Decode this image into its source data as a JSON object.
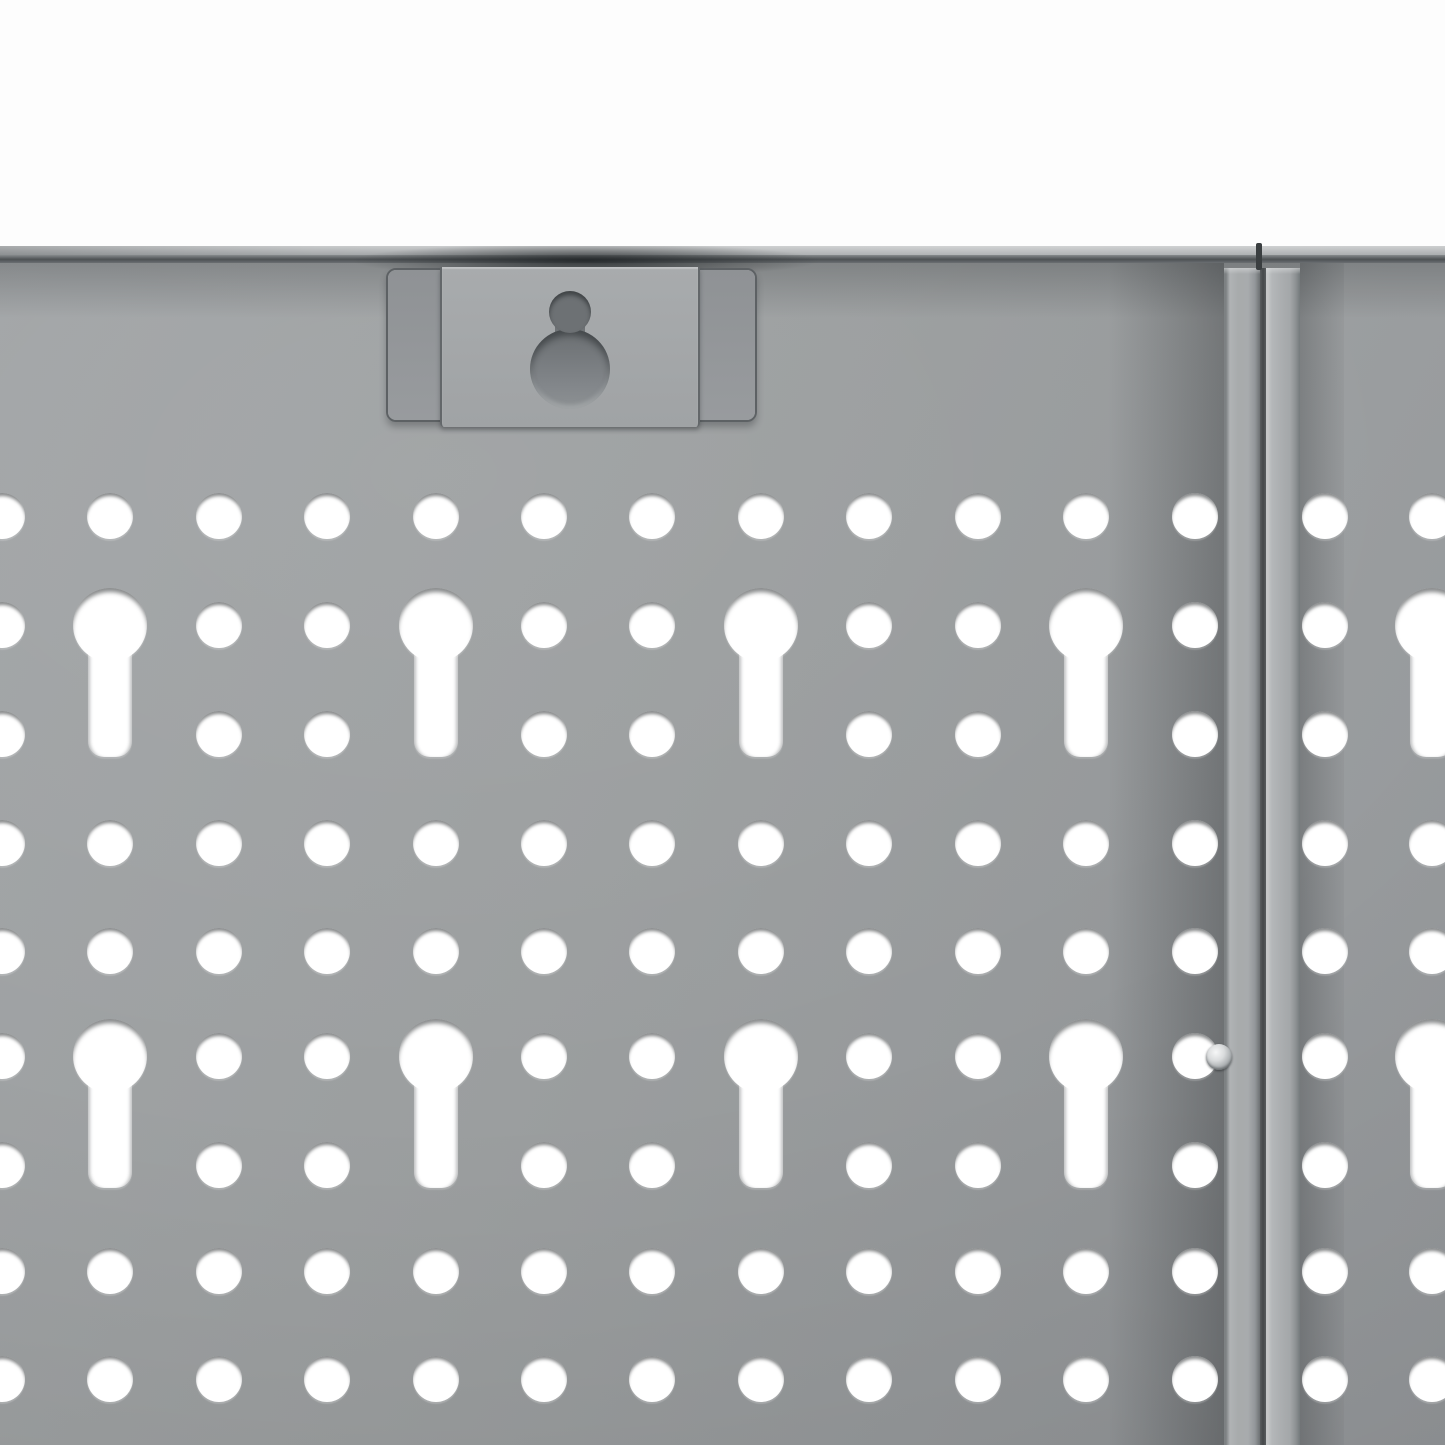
{
  "colors": {
    "background": "#fdfdfd",
    "panel-base": "#9b9e9f",
    "panel-light": "#a2a5a7",
    "panel-dark": "#8f9295",
    "hole-white": "#ffffff",
    "edge-line-dark": "#4d5154",
    "top-band-light": "#c9cbcc",
    "strip-face": "#a8abad",
    "strip-face-right": "#abaeb0",
    "bracket-face": "#9b9ea1",
    "bracket-tab": "#a8abad",
    "bracket-border": "#5d6164",
    "keyhole-interior-top": "#6d7174",
    "keyhole-interior-bottom": "#8d9193",
    "screw-highlight": "#f6f7f7",
    "screw-shade": "#6f7376"
  },
  "pegboard": {
    "hole_diameter": 46,
    "rows_y": [
      516,
      625,
      734,
      843,
      951,
      1056,
      1165,
      1271,
      1379
    ],
    "left_columns_x": [
      2,
      110,
      219,
      327,
      436,
      544,
      652,
      761,
      869,
      978,
      1086,
      1195
    ],
    "right_columns_x": [
      1325,
      1432
    ],
    "keyhole_rows": [
      1,
      5
    ],
    "stem_rows": [
      2,
      6
    ],
    "left_keyhole_column_indexes": [
      1,
      4,
      7,
      10
    ],
    "right_keyhole_column_indexes": [
      1
    ],
    "keyhole_head_diameter": 74,
    "keyhole_stem_width": 44,
    "keyhole_stem_length": 132
  },
  "seam": {
    "left_strip_x": 1224,
    "left_strip_width": 36,
    "gap_x": 1260,
    "gap_width": 6,
    "right_strip_x": 1266,
    "right_strip_width": 34,
    "crack_x": 1256,
    "crack_width": 6
  },
  "screw": {
    "cx": 1219,
    "cy": 1057,
    "diameter": 26
  },
  "bracket": {
    "x": 386,
    "y": 268,
    "width": 371,
    "height": 154,
    "tab_offset": 52,
    "tab_width": 260,
    "tab_extra_height": 10,
    "keyhole_small": {
      "cx": 570,
      "cy": 312,
      "r": 21
    },
    "keyhole_large": {
      "cx": 570,
      "cy": 369,
      "r": 40
    },
    "keyhole_neck_width": 30
  }
}
